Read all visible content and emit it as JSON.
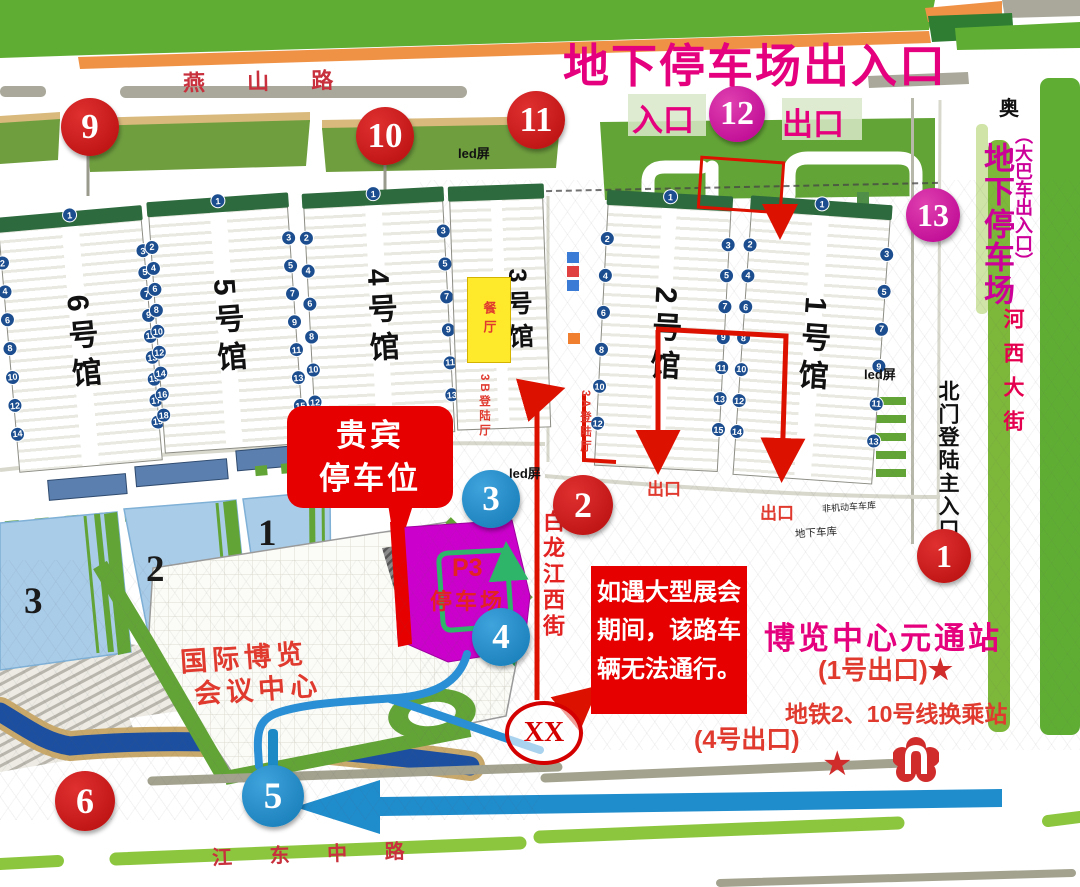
{
  "colors": {
    "title_magenta": "#e5007d",
    "marker_red": "#c01010",
    "marker_blue": "#1d8ac5",
    "marker_magenta": "#c9009c",
    "p3_magenta": "#cc00cc",
    "route_red": "#dd1100",
    "route_green": "#2fb56a",
    "route_blue": "#2a8fd4",
    "canal_blue": "#1c4fa0",
    "pool_blue": "#a9cce9",
    "band_green": "#5fae33",
    "verge_green": "#6f9e3f",
    "road_green": "#8cc63f",
    "orange": "#f09246",
    "restaurant_yellow": "#ffe92a",
    "warning_red": "#e60000",
    "text_red": "#e03a2f"
  },
  "title": {
    "main": "地下停车场出入口",
    "entry": "入口",
    "exit": "出口"
  },
  "roads": {
    "yanshan": "燕 山 路",
    "jiangdong": "江 东 中 路",
    "hexi": "河西大街",
    "bailongjiang": "白龙江西街"
  },
  "right_panel": {
    "ao": "奥",
    "bus": "（大巴车出入口）",
    "underground": "地下停车场",
    "north_gate": "北门登陆主入口"
  },
  "labels": {
    "vip_line1": "贵宾",
    "vip_line2": "停车位",
    "p3_line1": "P3",
    "p3_line2": "停车场",
    "expo_line1": "国际博览",
    "expo_line2": "会议中心",
    "restaurant": "餐厅",
    "landing_3b": "3B登陆厅",
    "landing_3a": "3A登陆厅",
    "exit_a": "出口",
    "exit_b": "出口",
    "non_motor_garage": "非机动车车库",
    "underground_garage": "地下车库",
    "led": "led屏",
    "blocked": "XX"
  },
  "warning": {
    "line1": "如遇大型展会",
    "line2": "期间，该路车",
    "line3": "辆无法通行。"
  },
  "metro": {
    "station": "博览中心元通站",
    "exit1": "(1号出口)",
    "star": "★",
    "transfer": "地铁2、10号线换乘站",
    "exit4": "(4号出口)"
  },
  "markers": [
    {
      "n": "9",
      "color": "red",
      "x": 90,
      "y": 127,
      "d": 58
    },
    {
      "n": "10",
      "color": "red",
      "x": 385,
      "y": 136,
      "d": 58
    },
    {
      "n": "11",
      "color": "red",
      "x": 536,
      "y": 120,
      "d": 58
    },
    {
      "n": "12",
      "color": "magenta",
      "x": 737,
      "y": 114,
      "d": 56
    },
    {
      "n": "13",
      "color": "magenta",
      "x": 933,
      "y": 215,
      "d": 54
    },
    {
      "n": "1",
      "color": "red",
      "x": 944,
      "y": 556,
      "d": 54
    },
    {
      "n": "2",
      "color": "red",
      "x": 583,
      "y": 505,
      "d": 60
    },
    {
      "n": "3",
      "color": "blue",
      "x": 491,
      "y": 499,
      "d": 58
    },
    {
      "n": "4",
      "color": "blue",
      "x": 501,
      "y": 637,
      "d": 58
    },
    {
      "n": "5",
      "color": "blue",
      "x": 273,
      "y": 796,
      "d": 62,
      "stem": true
    },
    {
      "n": "6",
      "color": "red",
      "x": 85,
      "y": 801,
      "d": 60
    }
  ],
  "halls": [
    {
      "label": "6号馆",
      "x": 8,
      "y": 213,
      "w": 142,
      "h": 252,
      "rot": -5,
      "gates": {
        "top": [
          "1"
        ],
        "left": [
          "2",
          "4",
          "6",
          "8",
          "10",
          "12",
          "14"
        ],
        "right": [
          "3",
          "5",
          "7",
          "9",
          "11",
          "13",
          "15",
          "17",
          "19"
        ]
      }
    },
    {
      "label": "5号馆",
      "x": 156,
      "y": 199,
      "w": 138,
      "h": 248,
      "rot": -4,
      "gates": {
        "top": [
          "1"
        ],
        "left": [
          "2",
          "4",
          "6",
          "8",
          "10",
          "12",
          "14",
          "16",
          "18"
        ],
        "right": [
          "3",
          "5",
          "7",
          "9",
          "11",
          "13",
          "15"
        ]
      }
    },
    {
      "label": "4号馆",
      "x": 309,
      "y": 192,
      "w": 138,
      "h": 242,
      "rot": -3,
      "gates": {
        "top": [
          "1"
        ],
        "left": [
          "2",
          "4",
          "6",
          "8",
          "10",
          "12"
        ],
        "right": [
          "3",
          "5",
          "7",
          "9",
          "11",
          "13"
        ]
      }
    },
    {
      "label": "3号馆",
      "x": 453,
      "y": 187,
      "w": 92,
      "h": 240,
      "rot": -2,
      "small": true,
      "gates": {
        "top": [],
        "left": [],
        "right": []
      }
    },
    {
      "label": "2号馆",
      "x": 601,
      "y": 195,
      "w": 122,
      "h": 272,
      "rot": 3,
      "gates": {
        "top": [
          "1"
        ],
        "left": [
          "2",
          "4",
          "6",
          "8",
          "10",
          "12"
        ],
        "right": [
          "3",
          "5",
          "7",
          "9",
          "11",
          "13",
          "15"
        ]
      }
    },
    {
      "label": "1号馆",
      "x": 742,
      "y": 202,
      "w": 138,
      "h": 276,
      "rot": 4,
      "gates": {
        "top": [
          "1"
        ],
        "left": [
          "2",
          "4",
          "6",
          "8",
          "10",
          "12",
          "14"
        ],
        "right": [
          "3",
          "5",
          "7",
          "9",
          "11",
          "13"
        ]
      }
    }
  ],
  "pools": [
    {
      "n": "1",
      "x": 258,
      "y": 512
    },
    {
      "n": "2",
      "x": 146,
      "y": 548
    },
    {
      "n": "3",
      "x": 24,
      "y": 580
    }
  ],
  "leds": [
    {
      "x": 458,
      "y": 143
    },
    {
      "x": 509,
      "y": 463
    },
    {
      "x": 864,
      "y": 364
    }
  ]
}
